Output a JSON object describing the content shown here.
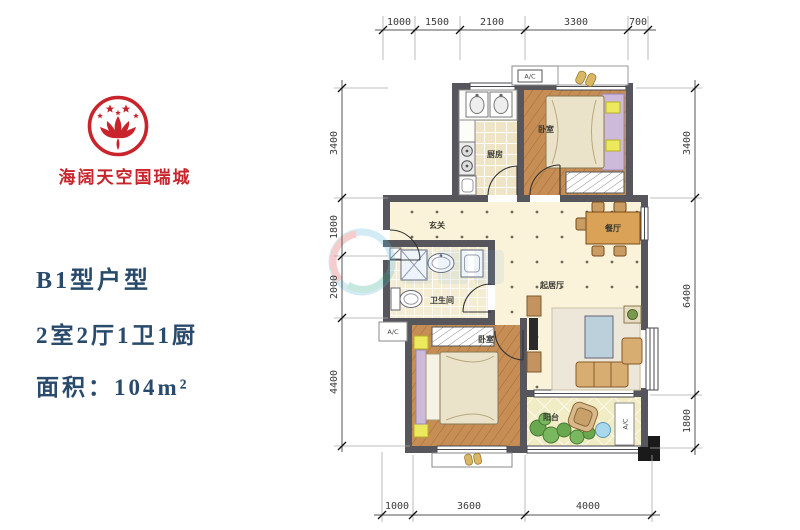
{
  "brand": {
    "logo": "lotus-star-emblem",
    "name": "海阔天空国瑞城"
  },
  "info": {
    "title": "B1型户型",
    "layout": "2室2厅1卫1厨",
    "area": "面积：104m²"
  },
  "plan": {
    "rooms": {
      "kitchen": "厨房",
      "bedroom_top": "卧室",
      "entry": "玄关",
      "dining": "餐厅",
      "bath": "卫生间",
      "living": "起居厅",
      "bedroom_bottom": "卧室",
      "balcony": "阳台"
    },
    "ac": "A/C",
    "dims": {
      "top": [
        "1000",
        "1500",
        "2100",
        "3300",
        "700"
      ],
      "left": [
        "3400",
        "1800",
        "2000",
        "4400"
      ],
      "right": [
        "3400",
        "6400",
        "1800"
      ],
      "bottom": [
        "1000",
        "3600",
        "4000"
      ]
    }
  },
  "colors": {
    "brand_red": "#c9242b",
    "info_navy": "#2a4a6b",
    "wall_gray": "#56565c",
    "wood_floor": "#c68e55",
    "cream_floor": "#faf3da"
  }
}
